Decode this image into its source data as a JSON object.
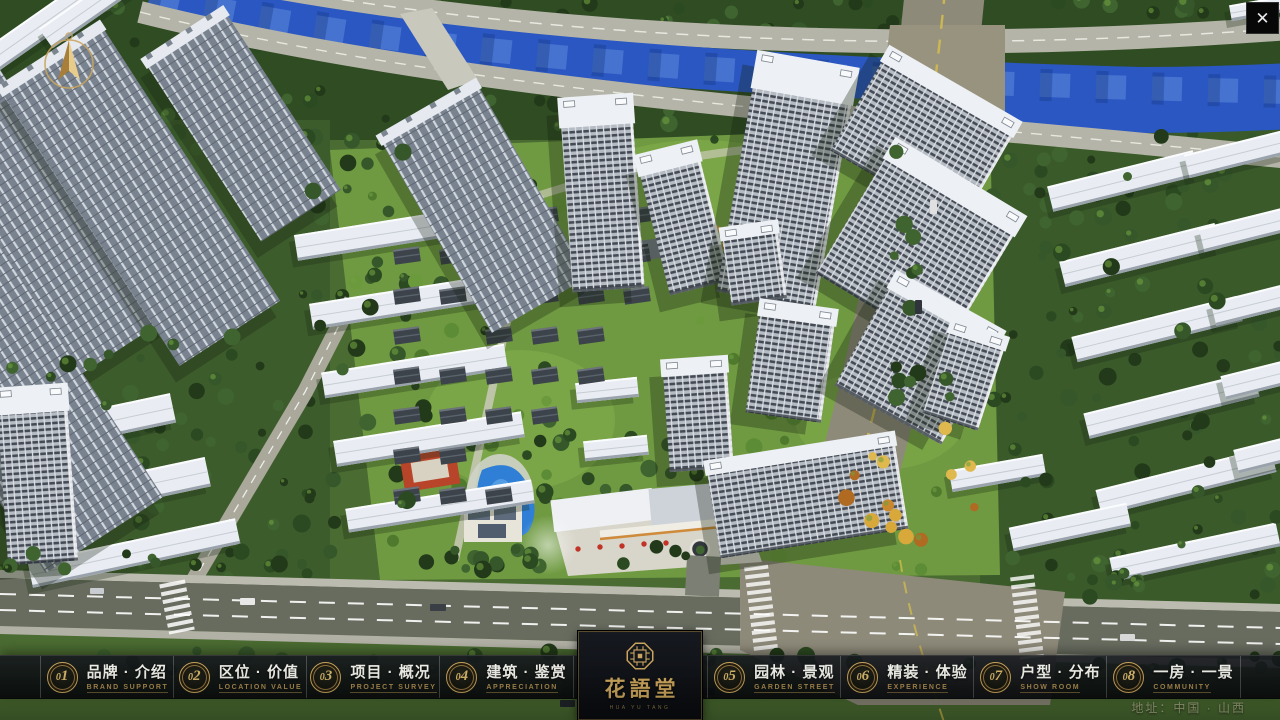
{
  "chrome": {
    "close_glyph": "✕"
  },
  "navbar": {
    "items": [
      {
        "num": "01",
        "zh": "品牌 · 介绍",
        "en": "BRAND SUPPORT"
      },
      {
        "num": "02",
        "zh": "区位 · 价值",
        "en": "LOCATION VALUE"
      },
      {
        "num": "03",
        "zh": "项目 · 概况",
        "en": "PROJECT SURVEY"
      },
      {
        "num": "04",
        "zh": "建筑 · 鉴赏",
        "en": "APPRECIATION"
      },
      {
        "num": "05",
        "zh": "园林 · 景观",
        "en": "GARDEN STREET"
      },
      {
        "num": "06",
        "zh": "精装 · 体验",
        "en": "EXPERIENCE"
      },
      {
        "num": "07",
        "zh": "户型 · 分布",
        "en": "SHOW ROOM"
      },
      {
        "num": "08",
        "zh": "一房 · 一景",
        "en": "COMMUNITY"
      }
    ]
  },
  "logo": {
    "name": "花語堂",
    "sub": "HUA YU TANG"
  },
  "footer": {
    "address": "地址：中国 · 山西"
  },
  "colors": {
    "gold": "#c9a55e",
    "river": "#2a57c2",
    "navbar_bg": "#0c0e11",
    "lawn": "#6f9a41"
  }
}
